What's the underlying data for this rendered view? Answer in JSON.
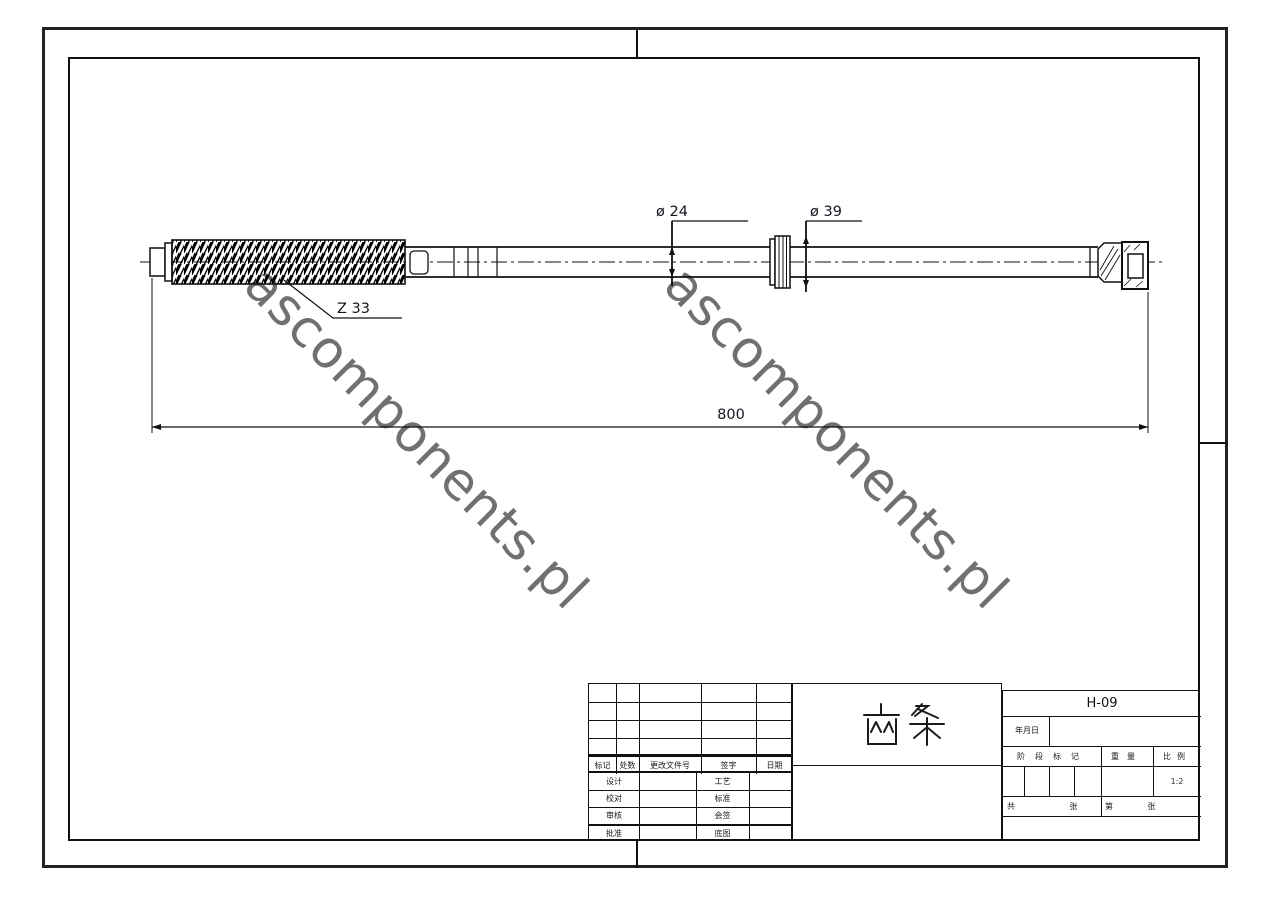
{
  "watermark": {
    "text": "ascomponents.pl",
    "color": "#707070"
  },
  "drawing": {
    "type": "mechanical part drawing (steering rack shaft)",
    "dimensions": {
      "shaft_diameter": "ø 24",
      "flange_diameter": "ø 39",
      "teeth_count": "Z 33",
      "overall_length": "800"
    }
  },
  "title_block": {
    "drawing_number": "H-09",
    "part_name": "齿条",
    "scale_value": "1:2",
    "revision_headers": [
      "标记",
      "处数",
      "更改文件号",
      "签字",
      "日期"
    ],
    "signature_rows": [
      {
        "left": "设计",
        "mid": "工艺"
      },
      {
        "left": "校对",
        "mid": "标准"
      },
      {
        "left": "审核",
        "mid": "会签"
      },
      {
        "left": "批准",
        "mid": "底图"
      }
    ],
    "right_block": {
      "date_label": "年月日",
      "stage_label": "阶段标记",
      "weight_label": "重量",
      "scale_label": "比例",
      "sheets_total_label": "共  张",
      "sheet_number_label": "第  张"
    },
    "colors": {
      "line": "#111111",
      "dimension_text": "#15151f"
    }
  }
}
